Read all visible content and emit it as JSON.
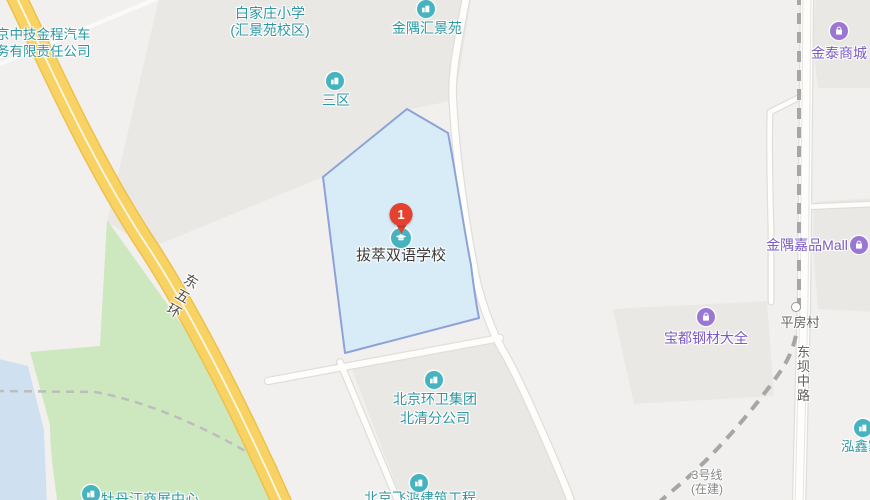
{
  "map": {
    "marker": {
      "number": "1",
      "title": "拔萃双语学校"
    },
    "pois": {
      "company": {
        "line1": "京中技金程汽车",
        "line2": "务有限责任公司"
      },
      "baijiazhuang_school": {
        "line1": "白家庄小学",
        "line2": "(汇景苑校区)"
      },
      "jinyu_huijingyuan": {
        "label": "金隅汇景苑"
      },
      "sanqu": {
        "label": "三区"
      },
      "jintai_mall": {
        "label": "金泰商城"
      },
      "jinyu_jiapin_mall": {
        "label": "金隅嘉品Mall"
      },
      "baodu_steel": {
        "label": "宝都钢材大全"
      },
      "pingfang_village": {
        "label": "平房村"
      },
      "huanwei_group": {
        "line1": "北京环卫集团",
        "line2": "北清分公司"
      },
      "feihong_construction": {
        "label": "北京飞鸿建筑工程"
      },
      "mudanjiang_center": {
        "label": "牡丹江商展中心"
      },
      "hongxin": {
        "label": "泓鑫家园"
      }
    },
    "roads": {
      "east_fifth_ring": "东五环",
      "dongba_middle_road": "东坝中路"
    },
    "transit": {
      "line3_name": "3号线",
      "line3_status": "(在建)"
    },
    "colors": {
      "background": "#F1F0EE",
      "block_gray": "#E9E8E4",
      "poi_teal_icon": "#45B4C0",
      "poi_teal_text": "#2D98A2",
      "poi_purple_icon": "#9B77D4",
      "poi_purple_text": "#7B5AC6",
      "marker_red": "#E6402F",
      "highlight_area_fill": "#D8ECF7",
      "highlight_area_stroke": "#8EA2D8",
      "park_green": "#CDE8BE",
      "water_blue": "#CFE1F0",
      "highway_yellow": "#F8D263",
      "highway_casing": "#ECC14E",
      "road_label_gray": "#5E5E5E",
      "selected_poi_text": "#3A3A3A",
      "transit_dash_gray": "#A6A6A6"
    }
  }
}
